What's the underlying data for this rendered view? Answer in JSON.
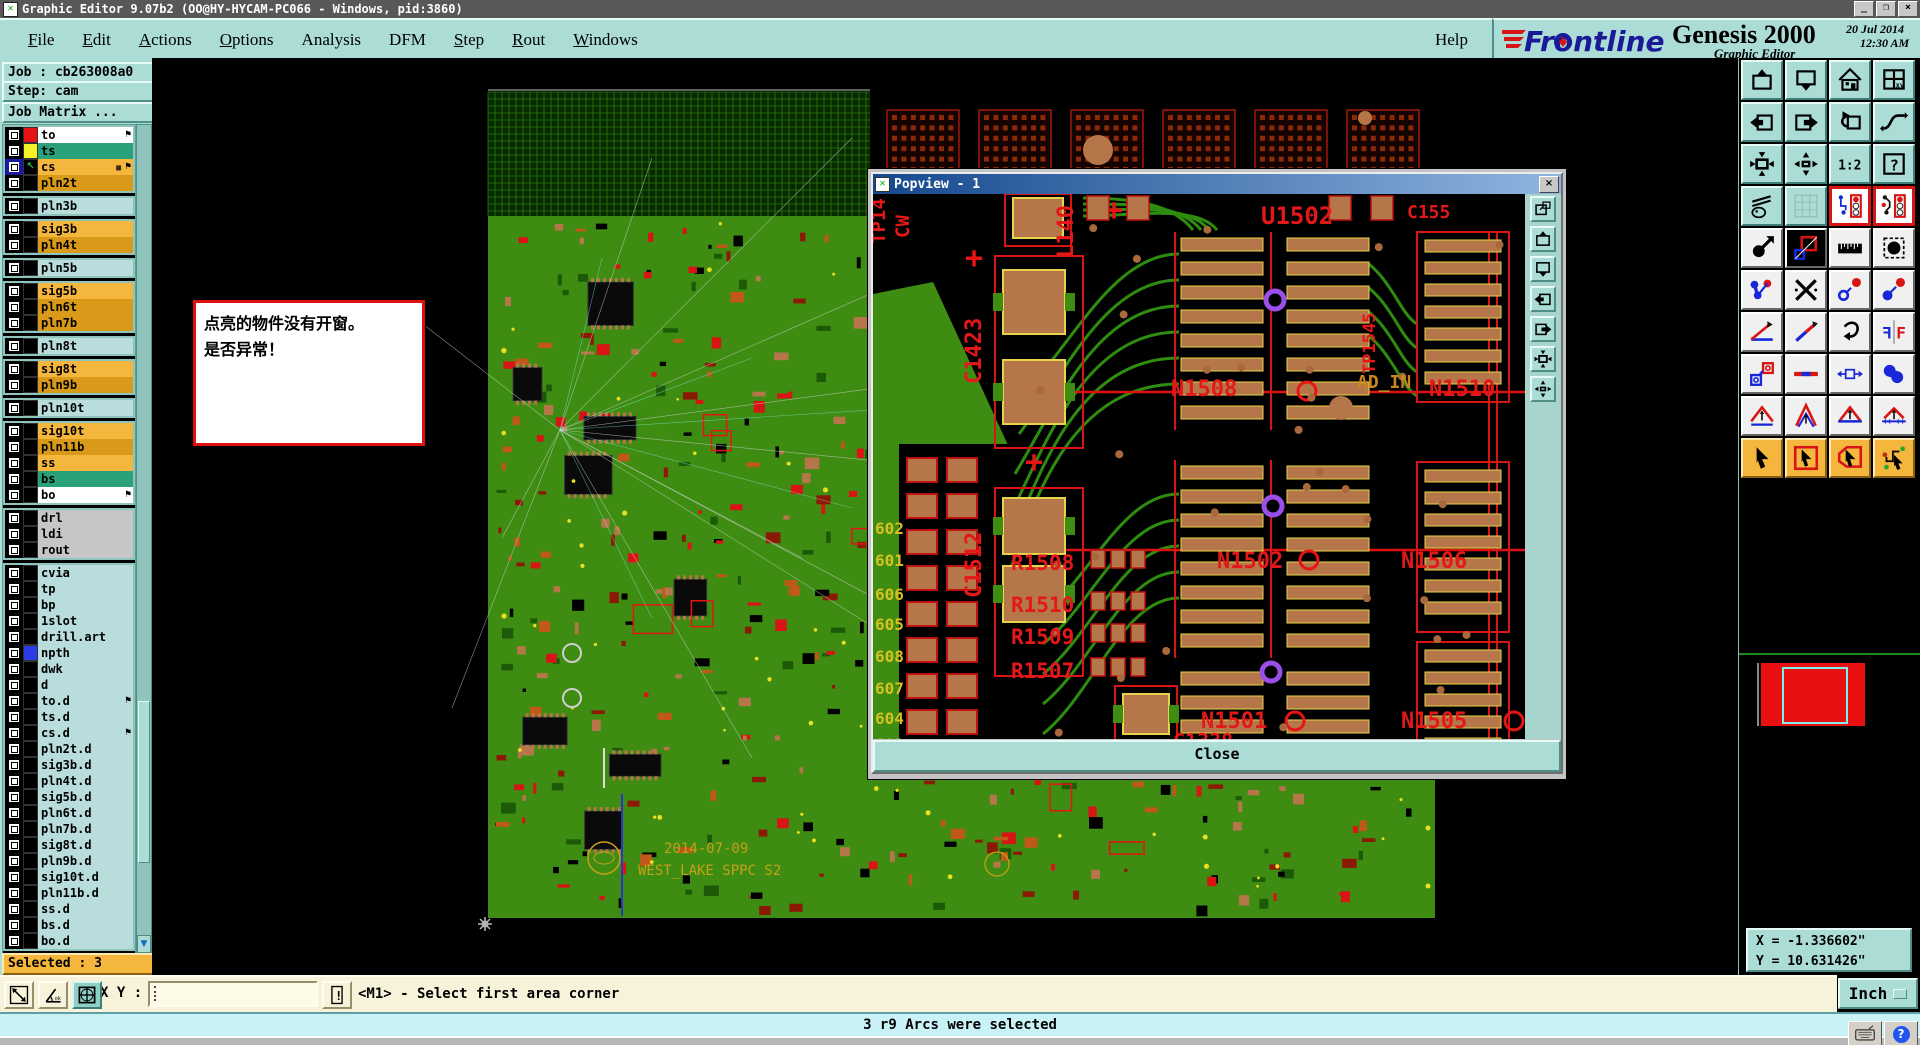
{
  "titlebar": {
    "title": "Graphic Editor 9.07b2 (OO@HY-HYCAM-PC066 - Windows, pid:3860)",
    "icon": "x-glyph",
    "buttons": [
      "_",
      "□",
      "×"
    ]
  },
  "menubar": {
    "items": [
      {
        "label": "File",
        "underline": 0
      },
      {
        "label": "Edit",
        "underline": 0
      },
      {
        "label": "Actions",
        "underline": 0
      },
      {
        "label": "Options",
        "underline": 0
      },
      {
        "label": "Analysis",
        "underline": -1
      },
      {
        "label": "DFM",
        "underline": -1
      },
      {
        "label": "Step",
        "underline": 0
      },
      {
        "label": "Rout",
        "underline": 0
      },
      {
        "label": "Windows",
        "underline": 0
      }
    ],
    "help": {
      "label": "Help",
      "underline": -1
    }
  },
  "brand": {
    "logo": "Frontline",
    "product": "Genesis 2000",
    "date": "20 Jul 2014",
    "time": "12:30 AM",
    "subtitle": "Graphic Editor",
    "logo_blue": "#1A1A99",
    "logo_red": "#D81414"
  },
  "job": {
    "job_label": "Job : cb263008a0",
    "step_label": "Step: cam",
    "matrix_button": "Job Matrix ..."
  },
  "layers": {
    "selected_label": "Selected : 3",
    "colors": {
      "orange": "#F5B63E",
      "gold": "#D99A19",
      "cyan": "#B9DCDC",
      "green": "#29A17B",
      "white": "#FFFFFF",
      "gray": "#C6C6C6"
    },
    "groups": [
      [
        {
          "name": "to",
          "bg": "white",
          "swatch": "#E81414",
          "flag": true
        },
        {
          "name": "ts",
          "bg": "green",
          "swatch": "#F2F229"
        },
        {
          "name": "cs",
          "bg": "orange",
          "swatch": "#000000",
          "flag": true,
          "grid": true,
          "cursor": true,
          "activebox": true
        },
        {
          "name": "pln2t",
          "bg": "gold",
          "swatch": "#000000"
        }
      ],
      [
        {
          "name": "pln3b",
          "bg": "cyan",
          "swatch": "#000000"
        }
      ],
      [
        {
          "name": "sig3b",
          "bg": "orange",
          "swatch": "#000000"
        },
        {
          "name": "pln4t",
          "bg": "gold",
          "swatch": "#000000"
        }
      ],
      [
        {
          "name": "pln5b",
          "bg": "cyan",
          "swatch": "#000000"
        }
      ],
      [
        {
          "name": "sig5b",
          "bg": "orange",
          "swatch": "#000000"
        },
        {
          "name": "pln6t",
          "bg": "gold",
          "swatch": "#000000"
        },
        {
          "name": "pln7b",
          "bg": "gold",
          "swatch": "#000000"
        }
      ],
      [
        {
          "name": "pln8t",
          "bg": "cyan",
          "swatch": "#000000"
        }
      ],
      [
        {
          "name": "sig8t",
          "bg": "orange",
          "swatch": "#000000"
        },
        {
          "name": "pln9b",
          "bg": "gold",
          "swatch": "#000000"
        }
      ],
      [
        {
          "name": "pln10t",
          "bg": "cyan",
          "swatch": "#000000"
        }
      ],
      [
        {
          "name": "sig10t",
          "bg": "orange",
          "swatch": "#000000"
        },
        {
          "name": "pln11b",
          "bg": "gold",
          "swatch": "#000000"
        },
        {
          "name": "ss",
          "bg": "orange",
          "swatch": "#000000"
        },
        {
          "name": "bs",
          "bg": "green",
          "swatch": "#000000"
        },
        {
          "name": "bo",
          "bg": "white",
          "swatch": "#000000",
          "flag": true
        }
      ],
      [
        {
          "name": "drl",
          "bg": "gray",
          "swatch": "#000000"
        },
        {
          "name": "ldi",
          "bg": "gray",
          "swatch": "#000000"
        },
        {
          "name": "rout",
          "bg": "gray",
          "swatch": "#000000"
        }
      ],
      [
        {
          "name": "cvia",
          "bg": "cyan",
          "swatch": "#000000"
        },
        {
          "name": "tp",
          "bg": "cyan",
          "swatch": "#000000"
        },
        {
          "name": "bp",
          "bg": "cyan",
          "swatch": "#000000"
        },
        {
          "name": "1slot",
          "bg": "cyan",
          "swatch": "#000000"
        },
        {
          "name": "drill.art",
          "bg": "cyan",
          "swatch": "#000000"
        },
        {
          "name": "npth",
          "bg": "cyan",
          "swatch": "#2B3BE8"
        },
        {
          "name": "dwk",
          "bg": "cyan",
          "swatch": "#000000"
        },
        {
          "name": "d",
          "bg": "cyan",
          "swatch": "#000000"
        },
        {
          "name": "to.d",
          "bg": "cyan",
          "swatch": "#000000",
          "flag": true
        },
        {
          "name": "ts.d",
          "bg": "cyan",
          "swatch": "#000000"
        },
        {
          "name": "cs.d",
          "bg": "cyan",
          "swatch": "#000000",
          "flag": true
        },
        {
          "name": "pln2t.d",
          "bg": "cyan",
          "swatch": "#000000"
        },
        {
          "name": "sig3b.d",
          "bg": "cyan",
          "swatch": "#000000"
        },
        {
          "name": "pln4t.d",
          "bg": "cyan",
          "swatch": "#000000"
        },
        {
          "name": "sig5b.d",
          "bg": "cyan",
          "swatch": "#000000"
        },
        {
          "name": "pln6t.d",
          "bg": "cyan",
          "swatch": "#000000"
        },
        {
          "name": "pln7b.d",
          "bg": "cyan",
          "swatch": "#000000"
        },
        {
          "name": "sig8t.d",
          "bg": "cyan",
          "swatch": "#000000"
        },
        {
          "name": "pln9b.d",
          "bg": "cyan",
          "swatch": "#000000"
        },
        {
          "name": "sig10t.d",
          "bg": "cyan",
          "swatch": "#000000"
        },
        {
          "name": "pln11b.d",
          "bg": "cyan",
          "swatch": "#000000"
        },
        {
          "name": "ss.d",
          "bg": "cyan",
          "swatch": "#000000"
        },
        {
          "name": "bs.d",
          "bg": "cyan",
          "swatch": "#000000"
        },
        {
          "name": "bo.d",
          "bg": "cyan",
          "swatch": "#000000"
        }
      ]
    ]
  },
  "message_box": {
    "lines": [
      "点亮的物件没有开窗。",
      "是否异常！"
    ]
  },
  "popview": {
    "title": "Popview - 1",
    "close_button": "Close",
    "close_x": "×",
    "labels": [
      {
        "t": "TP14",
        "x": 12,
        "y": 50,
        "r": -90,
        "c": "#E41818",
        "s": 19
      },
      {
        "t": "CW",
        "x": 36,
        "y": 44,
        "r": -90,
        "c": "#E41818",
        "s": 19
      },
      {
        "t": "C1423",
        "x": 108,
        "y": 190,
        "r": -90,
        "c": "#E41818",
        "s": 22
      },
      {
        "t": "L140",
        "x": 200,
        "y": 64,
        "r": -90,
        "c": "#E41818",
        "s": 22
      },
      {
        "t": "U1502",
        "x": 388,
        "y": 30,
        "r": 0,
        "c": "#E41818",
        "s": 24
      },
      {
        "t": "C155",
        "x": 534,
        "y": 24,
        "r": 0,
        "c": "#E41818",
        "s": 18
      },
      {
        "t": "TP1545",
        "x": 502,
        "y": 180,
        "r": -90,
        "c": "#E41818",
        "s": 17
      },
      {
        "t": "AD_IN",
        "x": 484,
        "y": 194,
        "r": 0,
        "c": "#C8861E",
        "s": 18
      },
      {
        "t": "N1510",
        "x": 556,
        "y": 202,
        "r": 0,
        "c": "#E41818",
        "s": 22
      },
      {
        "t": "N1508",
        "x": 298,
        "y": 202,
        "r": 0,
        "c": "#E41818",
        "s": 22
      },
      {
        "t": "C1512",
        "x": 108,
        "y": 404,
        "r": -90,
        "c": "#E41818",
        "s": 22
      },
      {
        "t": "N1502",
        "x": 344,
        "y": 374,
        "r": 0,
        "c": "#E41818",
        "s": 22
      },
      {
        "t": "N1506",
        "x": 528,
        "y": 374,
        "r": 0,
        "c": "#E41818",
        "s": 22
      },
      {
        "t": "R1508",
        "x": 138,
        "y": 376,
        "r": 0,
        "c": "#E41818",
        "s": 21
      },
      {
        "t": "R1510",
        "x": 138,
        "y": 418,
        "r": 0,
        "c": "#E41818",
        "s": 21
      },
      {
        "t": "R1509",
        "x": 138,
        "y": 450,
        "r": 0,
        "c": "#E41818",
        "s": 21
      },
      {
        "t": "R1507",
        "x": 138,
        "y": 484,
        "r": 0,
        "c": "#E41818",
        "s": 21
      },
      {
        "t": "N1501",
        "x": 328,
        "y": 534,
        "r": 0,
        "c": "#E41818",
        "s": 22
      },
      {
        "t": "N1505",
        "x": 528,
        "y": 534,
        "r": 0,
        "c": "#E41818",
        "s": 22
      },
      {
        "t": "C1338",
        "x": 300,
        "y": 554,
        "r": 0,
        "c": "#E41818",
        "s": 20
      },
      {
        "t": "602",
        "x": 2,
        "y": 340,
        "r": 0,
        "c": "#D8C020",
        "s": 16
      },
      {
        "t": "601",
        "x": 2,
        "y": 372,
        "r": 0,
        "c": "#D8C020",
        "s": 16
      },
      {
        "t": "606",
        "x": 2,
        "y": 406,
        "r": 0,
        "c": "#D8C020",
        "s": 16
      },
      {
        "t": "605",
        "x": 2,
        "y": 436,
        "r": 0,
        "c": "#D8C020",
        "s": 16
      },
      {
        "t": "608",
        "x": 2,
        "y": 468,
        "r": 0,
        "c": "#D8C020",
        "s": 16
      },
      {
        "t": "607",
        "x": 2,
        "y": 500,
        "r": 0,
        "c": "#D8C020",
        "s": 16
      },
      {
        "t": "604",
        "x": 2,
        "y": 530,
        "r": 0,
        "c": "#D8C020",
        "s": 16
      },
      {
        "t": "603",
        "x": 2,
        "y": 556,
        "r": 0,
        "c": "#D8C020",
        "s": 16
      }
    ]
  },
  "board_silk": {
    "date": "2014-07-09",
    "name": "WEST_LAKE SPPC S2"
  },
  "toolbar_right": {
    "rows": [
      [
        "view-up",
        "view-down",
        "home-view",
        "split-xy"
      ],
      [
        "pan-into-left",
        "pan-out-right",
        "previous-view",
        "serpentine"
      ],
      [
        "zoom-fit",
        "zoom-out-fit",
        "scale-1-2",
        "query"
      ],
      [
        "tools-setup",
        "grid-toggle",
        "highlight-a",
        "highlight-b"
      ],
      [
        "copy-select",
        "move-layers",
        "measure-ruler",
        "select-pad"
      ],
      [
        "chain-select",
        "delete",
        "swap-small",
        "swap-large"
      ],
      [
        "angle-measure",
        "slant-line",
        "reroute",
        "mirror"
      ],
      [
        "copy-pad",
        "break-line",
        "stretch",
        "join-shapes"
      ],
      [
        "arc-1",
        "arc-2",
        "arc-3",
        "arc-4"
      ],
      [
        "select-cursor",
        "select-window",
        "select-polygon",
        "select-net"
      ]
    ]
  },
  "popview_tools": [
    "popout",
    "view-up",
    "view-down",
    "pan-into-left",
    "pan-out-right",
    "zoom-fit",
    "zoom-out-fit"
  ],
  "command_bar": {
    "buttons": [
      "measure-diag",
      "measure-ang2",
      "grid-win"
    ],
    "xy_label": "X Y :",
    "xy_value": "",
    "alert_icon": "excl",
    "prompt": "<M1> - Select first area corner"
  },
  "statusbar": {
    "message": "3 r9 Arcs were selected"
  },
  "coords": {
    "x": "X = -1.336602\"",
    "y": "Y = 10.631426\"",
    "units": "Inch"
  }
}
